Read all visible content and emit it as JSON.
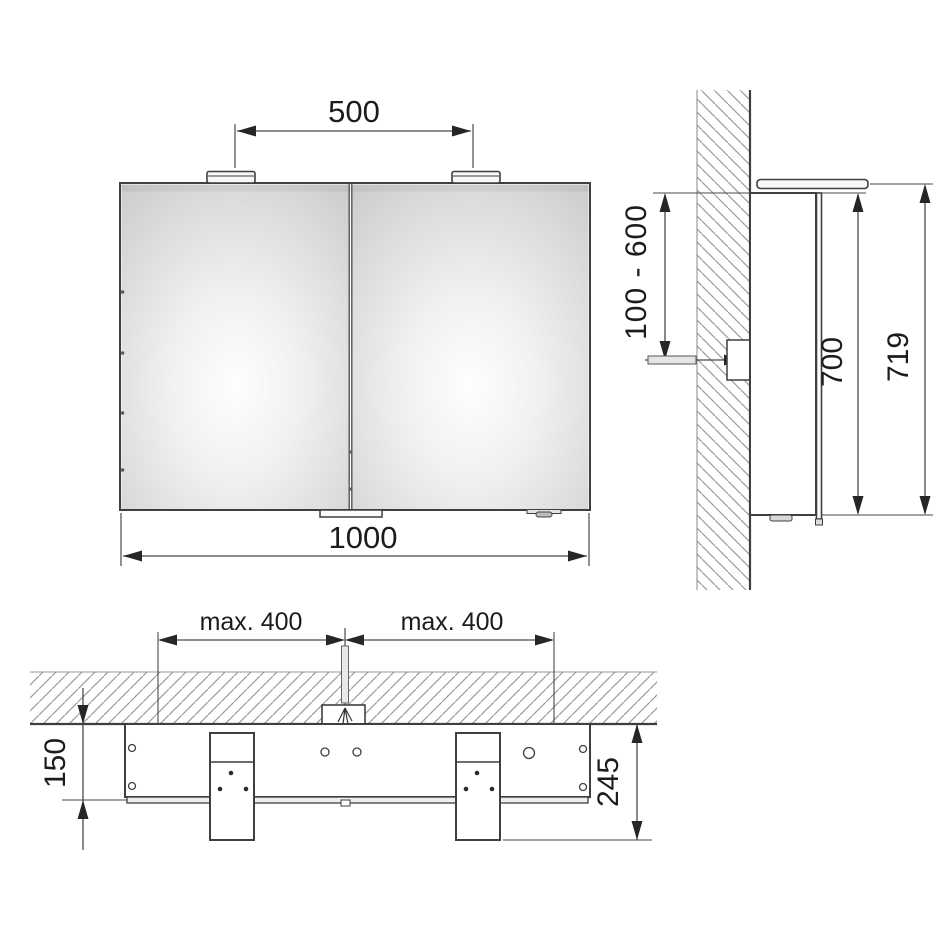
{
  "colors": {
    "background": "#ffffff",
    "object_line": "#3f3f3f",
    "dimension_line": "#4a4a4a",
    "hatch": "#9a9a9a",
    "text": "#1c1c1c",
    "mirror_center": "#fefefe",
    "mirror_edge": "#cbcbcb"
  },
  "front": {
    "light_spacing": "500",
    "overall_width": "1000"
  },
  "side": {
    "connection_height_range": "100 - 600",
    "cabinet_height": "700",
    "overall_height": "719"
  },
  "top": {
    "max_offset_left": "max. 400",
    "max_offset_right": "max. 400",
    "cabinet_depth": "150",
    "overall_depth": "245"
  }
}
